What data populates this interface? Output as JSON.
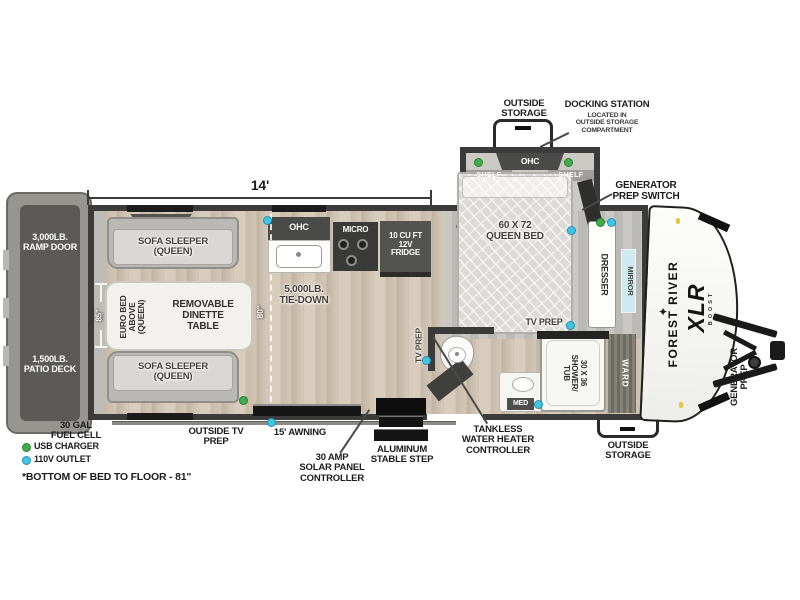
{
  "dimensions": {
    "main_length": "14'",
    "garage_opening_height": "85\"",
    "garage_depth": "80\"",
    "bed_to_floor_note": "*BOTTOM OF BED TO FLOOR - 81\""
  },
  "branding": {
    "make": "FOREST RIVER",
    "model": "XLR",
    "model_series": "BOOST"
  },
  "legend": {
    "usb_charger": {
      "label": "USB CHARGER",
      "color": "#3fae49"
    },
    "outlet_110v": {
      "label": "110V OUTLET",
      "color": "#3ec6e8"
    }
  },
  "exterior": {
    "outside_storage_top": "OUTSIDE\nSTORAGE",
    "docking_station_title": "DOCKING STATION",
    "docking_station_sub": "LOCATED IN\nOUTSIDE STORAGE\nCOMPARTMENT",
    "generator_prep_switch": "GENERATOR\nPREP SWITCH",
    "ramp_door": "3,000LB.\nRAMP DOOR",
    "patio_deck": "1,500LB.\nPATIO DECK",
    "fuel_cell": "30 GAL\nFUEL CELL",
    "outside_tv_prep": "OUTSIDE TV\nPREP",
    "awning": "15' AWNING",
    "solar_controller": "30 AMP\nSOLAR PANEL\nCONTROLLER",
    "stable_step": "ALUMINUM\nSTABLE STEP",
    "tankless_controller": "TANKLESS\nWATER HEATER\nCONTROLLER",
    "outside_storage_bottom": "OUTSIDE\nSTORAGE",
    "generator_prep": "GENERATOR\nPREP"
  },
  "interior": {
    "bedroom": {
      "ohc": "OHC",
      "shelf_left": "SHELF",
      "shelf_right": "SHELF",
      "bed": "60 X 72\nQUEEN BED",
      "dresser": "DRESSER",
      "mirror": "MIRROR",
      "tv_prep": "TV PREP"
    },
    "bath": {
      "shower": "30 X 36\nSHOWER/\nTUB",
      "ward": "WARD",
      "med": "MED",
      "tv_prep": "TV PREP"
    },
    "kitchen": {
      "ohc": "OHC",
      "micro": "MICRO",
      "fridge": "10 CU FT\n12V\nFRIDGE",
      "tie_down": "5,000LB.\nTIE-DOWN"
    },
    "garage": {
      "sofa_top": "SOFA SLEEPER\n(QUEEN)",
      "sofa_bottom": "SOFA SLEEPER\n(QUEEN)",
      "euro_bed": "EURO BED\nABOVE\n(QUEEN)",
      "dinette": "REMOVABLE\nDINETTE\nTABLE"
    }
  }
}
